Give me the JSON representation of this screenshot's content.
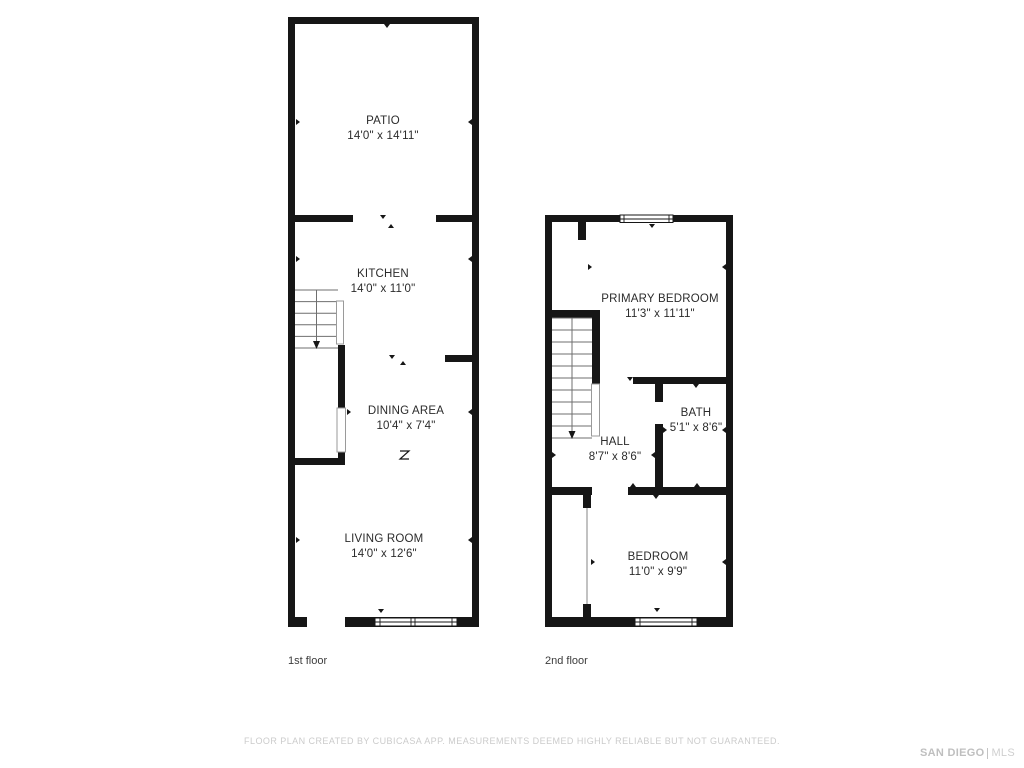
{
  "floors": [
    {
      "label": "1st floor",
      "rooms": [
        {
          "name": "PATIO",
          "dims": "14'0\" x 14'11\""
        },
        {
          "name": "KITCHEN",
          "dims": "14'0\" x 11'0\""
        },
        {
          "name": "DINING AREA",
          "dims": "10'4\" x 7'4\""
        },
        {
          "name": "LIVING ROOM",
          "dims": "14'0\" x 12'6\""
        }
      ]
    },
    {
      "label": "2nd floor",
      "rooms": [
        {
          "name": "PRIMARY BEDROOM",
          "dims": "11'3\" x 11'11\""
        },
        {
          "name": "BATH",
          "dims": "5'1\" x 8'6\""
        },
        {
          "name": "HALL",
          "dims": "8'7\" x 8'6\""
        },
        {
          "name": "BEDROOM",
          "dims": "11'0\" x 9'9\""
        }
      ]
    }
  ],
  "footer": {
    "disclaimer": "FLOOR PLAN CREATED BY CUBICASA APP. MEASUREMENTS DEEMED HIGHLY RELIABLE BUT NOT GUARANTEED."
  },
  "logo": {
    "brand": "SAN DIEGO",
    "suffix": "MLS"
  },
  "colors": {
    "wall": "#161616",
    "stair_line": "#6f6f6f",
    "label_text": "#2b2b2b",
    "muted_text": "#cbcbcb"
  }
}
